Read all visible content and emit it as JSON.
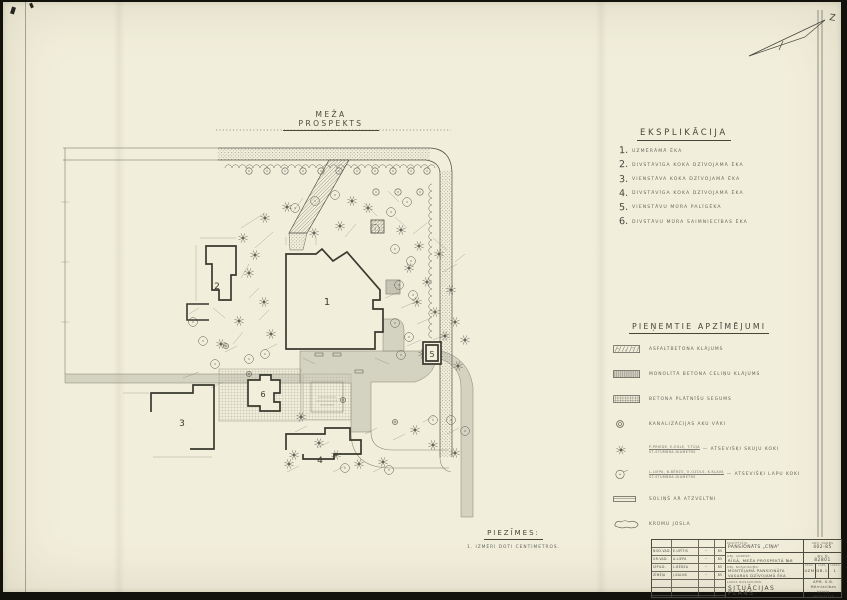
{
  "colors": {
    "paper": "#f1eedb",
    "ink": "#45443a",
    "line": "#55534a",
    "gray": "#b8b6a8"
  },
  "north": {
    "label": "Z"
  },
  "street": {
    "name": "MEŽA PROSPEKTS"
  },
  "explication": {
    "heading": "EKSPLIKĀCIJA",
    "items": [
      {
        "num": "1.",
        "text": "UZMĒRĀMĀ ĒKA"
      },
      {
        "num": "2.",
        "text": "DIVSTĀVĪGA KOKA DZĪVOJAMĀ ĒKA"
      },
      {
        "num": "3.",
        "text": "VIENSTĀVA KOKA DZĪVOJAMĀ ĒKA"
      },
      {
        "num": "4.",
        "text": "DIVSTĀVĪGA KOKA DZĪVOJAMĀ ĒKA"
      },
      {
        "num": "5.",
        "text": "VIENSTĀVU MŪRA PALĪGĒKA"
      },
      {
        "num": "6.",
        "text": "DIVSTĀVU MŪRA SAIMNIECĪBAS ĒKA"
      }
    ]
  },
  "legend": {
    "heading": "PIEŅEMTIE APZĪMĒJUMI",
    "items": [
      {
        "swatch": "asphalt",
        "text": "ASFALTBETONA KLĀJUMS"
      },
      {
        "swatch": "concrete",
        "text": "MONOLĪTĀ BETONA CELIŅU KLĀJUMS"
      },
      {
        "swatch": "slabs",
        "text": "BETONA PLĀTNĪŠU SEGUMS"
      },
      {
        "swatch": "manhole",
        "text": "KANALIZĀCIJAS AKU VĀKI"
      },
      {
        "swatch": "conifer",
        "sub1": "P-PRIEDE, E-EGLE, T-TŪJA",
        "sub2": "ST-STUMBRA DIAMETRS",
        "text": "— ATSEVIŠĶI SKUJU KOKI"
      },
      {
        "swatch": "deciduous",
        "sub1": "L-LIEPA, B-BĒRZS, O-OZOLS, K-KĻAVA",
        "sub2": "ST-STUMBRA DIAMETRS",
        "text": "— ATSEVIŠĶI LAPU KOKI"
      },
      {
        "swatch": "bench",
        "text": "SOLIŅŠ AR ATZVELTNI"
      },
      {
        "swatch": "shrub",
        "text": "KRŪMU JOSLA"
      }
    ]
  },
  "notes": {
    "heading": "PIEZĪMES:",
    "line": "1. IZMĒRI DOTI CENTIMETROS."
  },
  "titleblock": {
    "client_label": "PASŪTĪTĀJS:",
    "client": "PANSIONĀTS „CĪŅA”",
    "order_label": "ARH. DARBS",
    "order": "402-85",
    "address_label": "OBJ. ADRESE:",
    "address": "RĪGĀ, MEŽA PROSPEKTĀ №8",
    "inv_label": "INV. №",
    "inv": "82801",
    "object_label": "OBJ. NOSAUKUMS:",
    "object_line1": "MONTĒJAMĀ PANSIONĀTA",
    "object_line2": "VASARAS DZĪVOJAMĀ ĒKA",
    "stage_label": "STAD.",
    "stage": "UZM",
    "sheet_label": "LAPA",
    "sheet": "DB-1",
    "sheets_label": "LAPAS",
    "sheets": "1",
    "sheetname_label": "LAPAS NOSAUKUMS:",
    "sheetname": "SITUĀCIJAS PLĀNS",
    "org_line1": "APM. K.B.",
    "org_line2": "Mērniecības birojs",
    "org_line3": "INSTITŪTS",
    "signatures": [
      {
        "role": "NOD.VAD.",
        "name": "E.UPĪTIS",
        "sig": "~",
        "date": "85"
      },
      {
        "role": "GR.VAD.",
        "name": "A.LIEPA",
        "sig": "~",
        "date": "85"
      },
      {
        "role": "IZPILD.",
        "name": "L.BĒRZA",
        "sig": "~",
        "date": "85"
      },
      {
        "role": "ZĪMĒJA",
        "name": "J.KALNS",
        "sig": "~",
        "date": "85"
      }
    ]
  },
  "plan": {
    "buildings": [
      {
        "label": "1",
        "path": "M283,252 L313,252 L319,247 L330,259 L344,250 L377,288 L377,298 L370,298 L370,307 L380,307 L380,330 L372,330 L372,347 L283,347 Z",
        "lx": 324,
        "ly": 303,
        "fill": true,
        "fs": 10
      },
      {
        "label": "2",
        "path": "M203,244 L233,244 L233,273 L228,273 L228,298 L216,298 L216,288 L209,288 L209,262 L203,262 Z",
        "lx": 214,
        "ly": 287,
        "fill": true,
        "fs": 9
      },
      {
        "label": "3",
        "path": "M148,410 L148,391 L190,391 L190,383 L211,383 L211,447 L187,447",
        "lx": 179,
        "ly": 424,
        "fill": false,
        "fs": 9
      },
      {
        "label": "4",
        "path": "M283,448 L283,432 L322,432 L322,426 L347,426 L347,438 L358,438 L358,452 L331,452 L331,457 L300,457 L300,452",
        "lx": 317,
        "ly": 461,
        "fill": false,
        "fs": 9
      },
      {
        "label": "5",
        "path": "M420,340 L438,340 L438,362 L420,362 Z M423,343 L435,343 L435,359 L423,359 Z",
        "lx": 429,
        "ly": 355,
        "fill": true,
        "fs": 8
      },
      {
        "label": "6",
        "path": "M245,378 L257,378 L257,373 L268,373 L268,378 L277,378 L277,391 L271,391 L271,400 L277,400 L277,409 L257,409 L257,404 L245,404 Z",
        "lx": 260,
        "ly": 395,
        "fill": true,
        "fs": 8
      }
    ],
    "extra_outlines": [
      "M206,302 L184,302 L184,318 L206,318"
    ],
    "gray_areas": [
      "M297,349 L432,349 Q436,372 412,380 L368,380 L368,430 L348,430 L348,381 L297,381 Z",
      "M380,317 L394,317 Q401,319 401,328 L401,349 L380,349 Z",
      "M62,372 L297,372 L297,381 L62,381 Z",
      "M432,355 Q458,362 458,385 L458,515 L470,515 L470,385 Q466,356 438,349 Z"
    ],
    "grid_areas": [
      [
        216,
        367,
        82,
        52
      ],
      [
        300,
        372,
        48,
        46
      ],
      [
        368,
        218,
        13,
        13
      ],
      [
        383,
        278,
        14,
        14
      ]
    ],
    "inner_square": [
      308,
      380,
      32,
      30
    ],
    "street_top": [
      215,
      146,
      212,
      12
    ],
    "street_right": [
      437,
      168,
      12,
      287
    ],
    "dotted_line": [
      213,
      128,
      448,
      128
    ],
    "left_ext": [
      [
        60,
        146,
        215,
        146
      ],
      [
        60,
        158,
        215,
        158
      ]
    ],
    "site_left_line": [
      62,
      146,
      62,
      372
    ],
    "walkway": "326,158 346,158 304,231 286,231",
    "walkway2": "286,231 304,231 300,248 287,248",
    "thin_paths": [
      "M348,430 Q348,466 388,466 L446,466",
      "M368,430 Q368,448 390,448 L446,448",
      "M437,455 Q437,468 448,470"
    ],
    "circled_trees": [
      [
        246,
        169
      ],
      [
        264,
        169
      ],
      [
        282,
        169
      ],
      [
        300,
        169
      ],
      [
        318,
        169
      ],
      [
        336,
        169
      ],
      [
        354,
        169
      ],
      [
        372,
        169
      ],
      [
        390,
        169
      ],
      [
        408,
        169
      ],
      [
        424,
        169
      ],
      [
        373,
        190
      ],
      [
        395,
        190
      ],
      [
        417,
        190
      ]
    ],
    "conifers": [
      [
        262,
        216
      ],
      [
        284,
        205
      ],
      [
        240,
        236
      ],
      [
        252,
        253
      ],
      [
        246,
        271
      ],
      [
        261,
        300
      ],
      [
        236,
        319
      ],
      [
        268,
        332
      ],
      [
        218,
        342
      ],
      [
        349,
        199
      ],
      [
        311,
        231
      ],
      [
        337,
        224
      ],
      [
        365,
        206
      ],
      [
        398,
        228
      ],
      [
        416,
        244
      ],
      [
        436,
        252
      ],
      [
        406,
        266
      ],
      [
        424,
        280
      ],
      [
        448,
        288
      ],
      [
        414,
        300
      ],
      [
        432,
        310
      ],
      [
        452,
        320
      ],
      [
        442,
        334
      ],
      [
        462,
        338
      ],
      [
        420,
        352
      ],
      [
        455,
        364
      ],
      [
        298,
        415
      ],
      [
        316,
        441
      ],
      [
        333,
        453
      ],
      [
        291,
        453
      ],
      [
        412,
        428
      ],
      [
        430,
        443
      ],
      [
        452,
        451
      ],
      [
        286,
        462
      ],
      [
        380,
        460
      ],
      [
        356,
        462
      ]
    ],
    "deciduous": [
      [
        292,
        206
      ],
      [
        312,
        199
      ],
      [
        332,
        193
      ],
      [
        388,
        210
      ],
      [
        404,
        200
      ],
      [
        372,
        227
      ],
      [
        392,
        247
      ],
      [
        408,
        259
      ],
      [
        396,
        283
      ],
      [
        410,
        293
      ],
      [
        392,
        321
      ],
      [
        406,
        335
      ],
      [
        398,
        353
      ],
      [
        190,
        320
      ],
      [
        200,
        339
      ],
      [
        212,
        362
      ],
      [
        246,
        357
      ],
      [
        262,
        352
      ],
      [
        448,
        418
      ],
      [
        462,
        429
      ],
      [
        430,
        418
      ],
      [
        342,
        466
      ],
      [
        386,
        468
      ]
    ],
    "manholes": [
      [
        223,
        344
      ],
      [
        246,
        372
      ],
      [
        340,
        398
      ],
      [
        392,
        420
      ]
    ],
    "benches": [
      [
        312,
        351
      ],
      [
        330,
        351
      ],
      [
        352,
        368
      ]
    ],
    "fluff": [
      [
        197,
        236,
        233,
        236
      ],
      [
        193,
        243,
        193,
        299
      ],
      [
        238,
        226,
        262,
        211
      ],
      [
        270,
        230,
        252,
        246
      ],
      [
        300,
        196,
        290,
        210
      ],
      [
        283,
        243,
        283,
        235
      ],
      [
        313,
        243,
        313,
        235
      ],
      [
        342,
        235,
        353,
        222
      ],
      [
        361,
        201,
        374,
        214
      ],
      [
        385,
        189,
        396,
        200
      ],
      [
        392,
        215,
        404,
        226
      ],
      [
        410,
        232,
        424,
        221
      ],
      [
        430,
        236,
        444,
        248
      ],
      [
        452,
        260,
        462,
        252
      ],
      [
        440,
        270,
        454,
        262
      ],
      [
        246,
        262,
        238,
        276
      ],
      [
        256,
        286,
        246,
        296
      ],
      [
        266,
        308,
        256,
        318
      ],
      [
        240,
        330,
        230,
        342
      ],
      [
        210,
        306,
        222,
        316
      ],
      [
        186,
        312,
        196,
        306
      ],
      [
        382,
        296,
        396,
        290
      ],
      [
        398,
        306,
        412,
        300
      ],
      [
        414,
        322,
        428,
        316
      ],
      [
        430,
        338,
        444,
        332
      ],
      [
        404,
        344,
        418,
        338
      ],
      [
        372,
        356,
        386,
        362
      ],
      [
        300,
        356,
        312,
        362
      ],
      [
        262,
        348,
        274,
        342
      ],
      [
        222,
        350,
        234,
        344
      ],
      [
        180,
        376,
        196,
        370
      ],
      [
        208,
        386,
        220,
        380
      ],
      [
        292,
        430,
        304,
        424
      ],
      [
        314,
        446,
        326,
        440
      ],
      [
        362,
        432,
        374,
        426
      ],
      [
        390,
        438,
        402,
        432
      ],
      [
        420,
        420,
        432,
        414
      ],
      [
        444,
        432,
        456,
        426
      ],
      [
        284,
        470,
        296,
        464
      ],
      [
        330,
        470,
        342,
        464
      ],
      [
        370,
        470,
        382,
        464
      ],
      [
        58,
        200,
        66,
        200
      ],
      [
        58,
        260,
        66,
        260
      ],
      [
        58,
        320,
        66,
        320
      ],
      [
        120,
        391,
        146,
        391
      ],
      [
        150,
        455,
        209,
        455
      ]
    ]
  }
}
